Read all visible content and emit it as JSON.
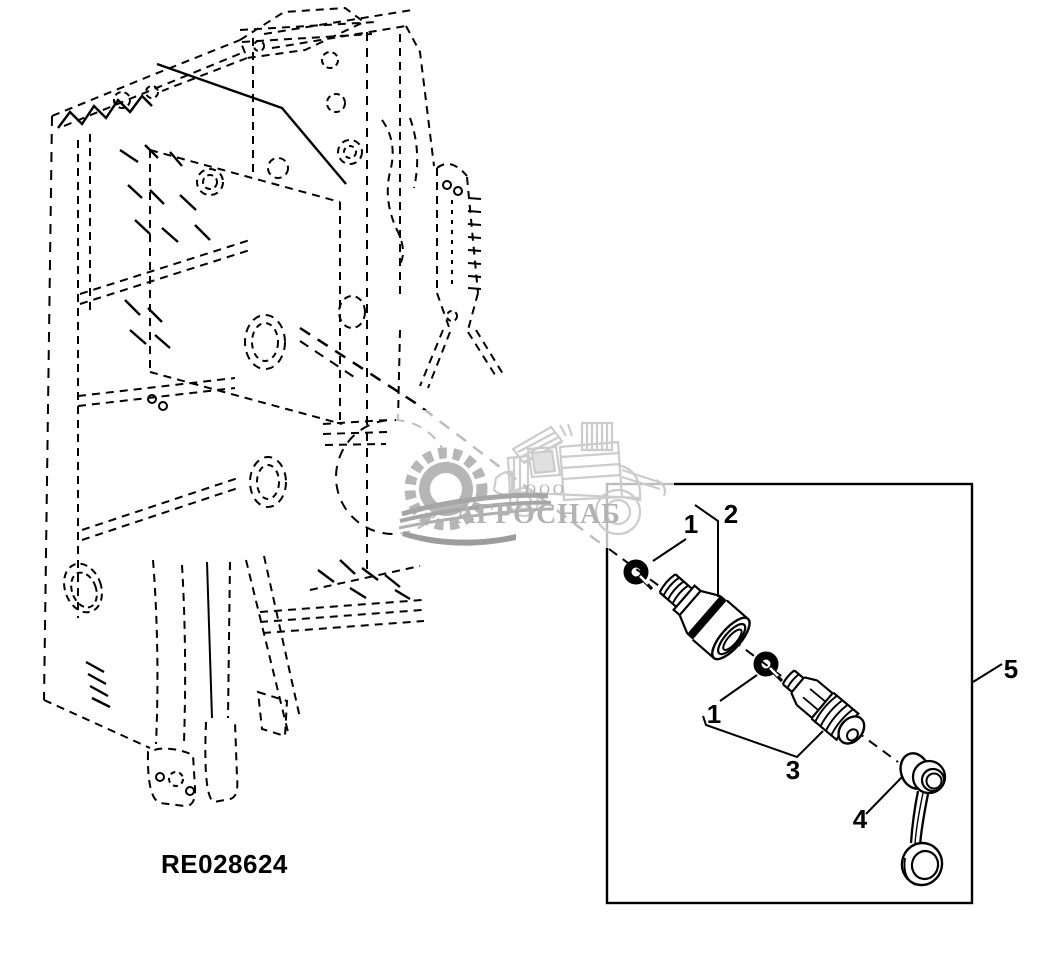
{
  "page": {
    "background_color": "#ffffff",
    "line_color": "#000000"
  },
  "drawing": {
    "part_number_label": "RE028624"
  },
  "callouts": {
    "c1a": "1",
    "c2": "2",
    "c1b": "1",
    "c3": "3",
    "c4": "4",
    "c5": "5"
  },
  "watermark": {
    "org_form": "ООО",
    "company": "АГРОСНАБ",
    "text_color": "#b2b2b2",
    "gear_color": "#b6b6b6",
    "swoosh_color": "#a6a6a6",
    "vehicle_color": "#cccccc"
  }
}
